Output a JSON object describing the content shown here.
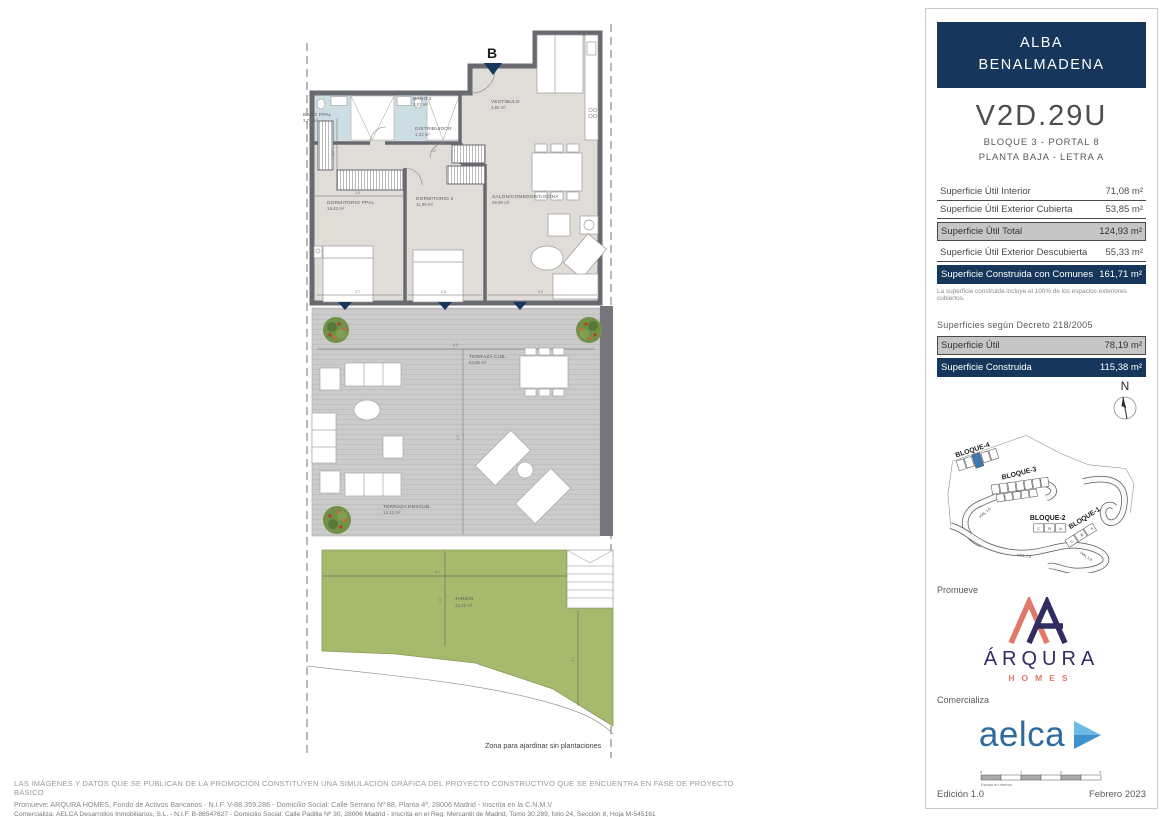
{
  "colors": {
    "navy": "#17365c",
    "highlight_unit_blue": "#3f79b4",
    "arqura_coral": "#e0796a",
    "arqura_navy": "#312d62",
    "aelca_blue": "#2e6ba1",
    "garden_green": "#a6ba6e",
    "row_gray": "#c6c6c6"
  },
  "plan": {
    "entrance_label": "B",
    "caption": "Zona para ajardinar sin plantaciones",
    "rooms": [
      {
        "name": "BAÑO PPAL",
        "area": "3,76 m²"
      },
      {
        "name": "BAÑO 2",
        "area": "3,07 m²"
      },
      {
        "name": "VESTÍBULO",
        "area": "4,80 m²"
      },
      {
        "name": "DISTRIBUIDOR",
        "area": "1,23 m²"
      },
      {
        "name": "DORMITORIO PPAL",
        "area": "16,42 m²"
      },
      {
        "name": "DORMITORIO 2",
        "area": "11,90 m²"
      },
      {
        "name": "SALÓN/COMEDOR/COCINA",
        "area": "29,90 m²"
      },
      {
        "name": "TERRAZA CUB.",
        "area": "53,85 m²"
      },
      {
        "name": "TERRAZA DESCUB.",
        "area": "13,12 m²"
      },
      {
        "name": "JARDÍN",
        "area": "42,21 m²"
      }
    ],
    "dims": [
      "1,7",
      "2,0",
      "1,2",
      "2,7",
      "2,5",
      "2,9",
      "5,5",
      "2,7",
      "8,1",
      "4,2",
      "3,4"
    ]
  },
  "panel": {
    "title_line1": "ALBA",
    "title_line2": "BENALMADENA",
    "unit_code": "V2D.29U",
    "unit_block": "BLOQUE 3 - PORTAL 8",
    "unit_floor": "PLANTA BAJA - LETRA A",
    "areas": [
      {
        "label": "Superficie Útil Interior",
        "value": "71,08 m²"
      },
      {
        "label": "Superficie Útil Exterior Cubierta",
        "value": "53,85 m²"
      },
      {
        "label": "Superficie Útil Total",
        "value": "124,93 m²"
      },
      {
        "label": "Superficie Útil Exterior Descubierta",
        "value": "55,33 m²"
      },
      {
        "label": "Superficie Construida con Comunes",
        "value": "161,71 m²"
      }
    ],
    "areas_note": "La superficie construida incluye el 100% de los espacios exteriores cubiertos.",
    "decree_heading": "Superficies según Decreto 218/2005",
    "decree_rows": [
      {
        "label": "Superficie Útil",
        "value": "78,19 m²"
      },
      {
        "label": "Superficie Construida",
        "value": "115,38 m²"
      }
    ],
    "compass_label": "N",
    "site_plan": {
      "blocks": [
        "BLOQUE-4",
        "BLOQUE-3",
        "BLOQUE-2",
        "BLOQUE-1"
      ],
      "road_label": "VIAL 1.0",
      "bloque2_units": [
        "C",
        "B",
        "A"
      ],
      "bloque1_units": [
        "C",
        "B",
        "A"
      ]
    },
    "promoter_label": "Promueve",
    "promoter_name": "ÁRQURA",
    "promoter_sub": "HOMES",
    "seller_label": "Comercializa",
    "seller_name": "aelca",
    "scale": {
      "caption": "Escala en metros",
      "ticks": [
        "0",
        "1",
        "2",
        "3"
      ]
    },
    "edition": "Edición 1.0",
    "date": "Febrero 2023"
  },
  "footer": {
    "line1": "LAS IMÁGENES Y DATOS QUE SE PUBLICAN DE LA PROMOCIÓN CONSTITUYEN UNA SIMULACIÓN GRÁFICA DEL PROYECTO CONSTRUCTIVO QUE SE ENCUENTRA EN FASE DE PROYECTO BÁSICO",
    "line2": "Promueve: ARQURA HOMES, Fondo de Activos Bancarios - N.I.F. V-88.359.286 - Domicilio Social: Calle Serrano Nº 88, Planta 4ª, 28006 Madrid - Inscrita en la C.N.M.V",
    "line3": "Comercializa: AELCA Desarrollos Inmobiliarios, S.L. - N.I.F. B-86547627 - Domicilio Social: Calle Padilla Nº 30, 28006 Madrid - Inscrita en el Reg. Mercantil de Madrid, Tomo 30.289, folio 24, Sección 8, Hoja M-545161"
  }
}
